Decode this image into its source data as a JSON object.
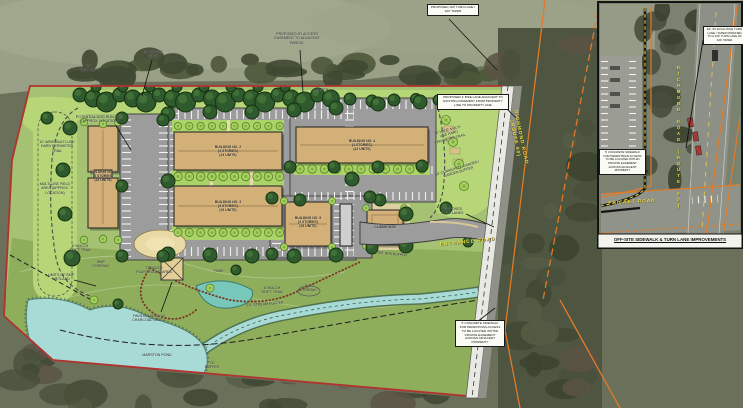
{
  "main": {
    "labels": {
      "buffer_nw": "20' BUFFER",
      "water_area": "EX. WATER AREA",
      "buffer_ne": "20' BUFFER",
      "access_easement": "PROPOSED 20' ACCESS EASEMENT TO ADJACENT PARCEL",
      "turn_lane_note": "PROPOSED 100' TURN LANE / 100' TAPER",
      "dog_run": "POTENTIAL DOG RUN AREA (APPROX. LOCATION)",
      "perimeter_trail_west": "10' WIDE MULTI-USE HARD PERIMETER TRAIL",
      "perimeter_trail_east": "10' WIDE MULTI-USE HARD PERIMETER TRAIL",
      "field": "MULTI-USE FIELD AREA (APPROX. LOCATION)",
      "community_garden": "50' COMMUNITY GARDEN / GARDEN BUFFER",
      "bike_lane_note": "PROPOSED 4' BIKE LANE ADJACENT TO EXISTING PAVEMENT FROM PROPERTY LINE TO PROPERTY LINE",
      "richmond_road": "RICHMOND ROAD\n(ROUTE 60)",
      "entrance_road": "ENTRANCE ROAD",
      "proposed_turn": "PROPOSED TURN LANES",
      "playground": "TODDLER PLAYGROUND AREA",
      "pavilion": "PAVILION AREA W/ CHARCOAL GRILLS",
      "mulch_trail_west": "6' MULCH 'SOFT' TRAIL",
      "mulch_trail_east": "6' MULCH 'SOFT' TRAIL",
      "forebay_west": "BMP FOREBAY",
      "forebay_east": "BMP FOREBAY",
      "wetland_limits": "LIMITS OF BMP WETLAND",
      "park": "PARK",
      "stream_buffer": "EX. STREAM BUFFER",
      "pond": "MARSTON POND",
      "buffer_75": "75' BUFFER",
      "rpa_buffer": "100' RPA BUFFER",
      "sidewalk_note": "5' CONCRETE SIDEWALK FOR PEDESTRIAN ACCESS TO BE LOCATED WITHIN PRIVATE EASEMENT ACROSS ADJACENT PROPERTY",
      "clubhouse": "CLUBHOUSE"
    },
    "buildings": [
      {
        "label": "BUILDING NO. 1\n(3 STORIES)\n(24 UNITS)"
      },
      {
        "label": "BUILDING NO. 2\n(3 STORIES)\n(24 UNITS)"
      },
      {
        "label": "BUILDING NO. 3\n(3 STORIES)\n(24 UNITS)"
      },
      {
        "label": "BUILDING NO. 4\n(3 STORIES)\n(42 UNITS)"
      },
      {
        "label": "BUILDING NO. 5\n(3 STORIES)\n(24 UNITS)"
      }
    ]
  },
  "inset": {
    "title": "OFF-SITE SIDEWALK & TURN LANE IMPROVEMENTS",
    "richmond_road": "RICHMOND ROAD (ROUTE 60)",
    "pricket_road": "PRICKET ROAD",
    "turn_lane_note": "EX. 50' EXCLUSIVE TURN LANE / TAPER MODIFIED TO A 100' TURN LANE W/ 100' TAPER",
    "sidewalk_note": "5' CONCRETE SIDEWALK FOR PEDESTRIAN ACCESS TO BE LOCATED WITHIN PRIVATE EASEMENT ACROSS ADJACENT PROPERTY"
  },
  "colors": {
    "boundary_red": "#b23230",
    "road_label_yellow": "#f2e03c",
    "utility_orange": "#e07b28",
    "water_blue": "#a9dbd6",
    "building_tan": "#d3b077",
    "lawn_green": "#b6d678",
    "canopy_green": "#2e5a2d"
  }
}
